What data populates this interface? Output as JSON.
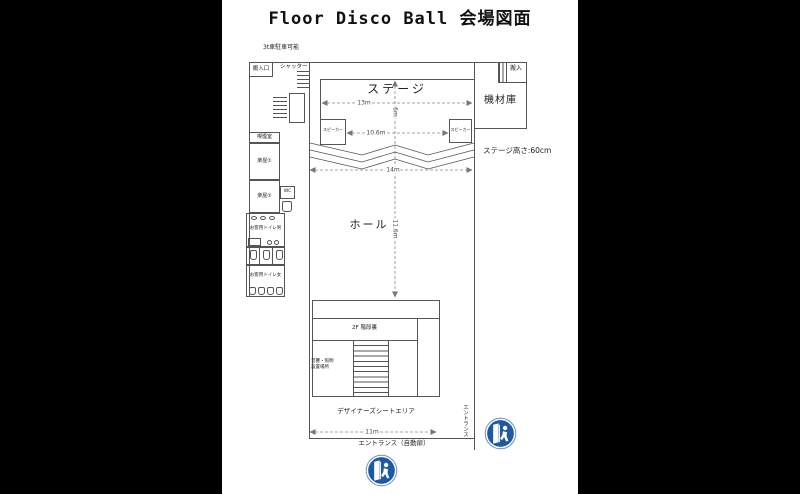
{
  "title": "Floor Disco Ball 会場図面",
  "notes": {
    "parking": "3t車駐車可能",
    "stage_height": "ステージ高さ:60cm"
  },
  "areas": {
    "loading_entrance": "搬入口",
    "shutter": "シャッター",
    "stage": "ステージ",
    "speaker": "スピーカー",
    "equipment_room": "機材庫",
    "loading": "搬入",
    "smoking_room": "喫煙室",
    "dressing_room_1": "楽屋①",
    "dressing_room_2": "楽屋②",
    "wc": "WC",
    "toilet_men": "お客用トイレ男",
    "toilet_women": "お客用トイレ女",
    "hall": "ホール",
    "stairs_2f": "2F 階段裏",
    "sound_light_line1": "音響・照明",
    "sound_light_line2": "設置場所",
    "designer_seat_area": "デザイナーズシートエリア",
    "entrance_auto_door": "エントランス（自動扉）",
    "entrance_side": "エントランス"
  },
  "dimensions": {
    "stage_width": "13m",
    "stage_depth": "6m",
    "speaker_span": "10.6m",
    "hall_width": "14m",
    "hall_depth": "11.6m",
    "designer_area_width": "11m"
  },
  "colors": {
    "background": "#000000",
    "paper": "#ffffff",
    "line": "#555555",
    "entrance_icon_blue": "#1e5aa4"
  }
}
